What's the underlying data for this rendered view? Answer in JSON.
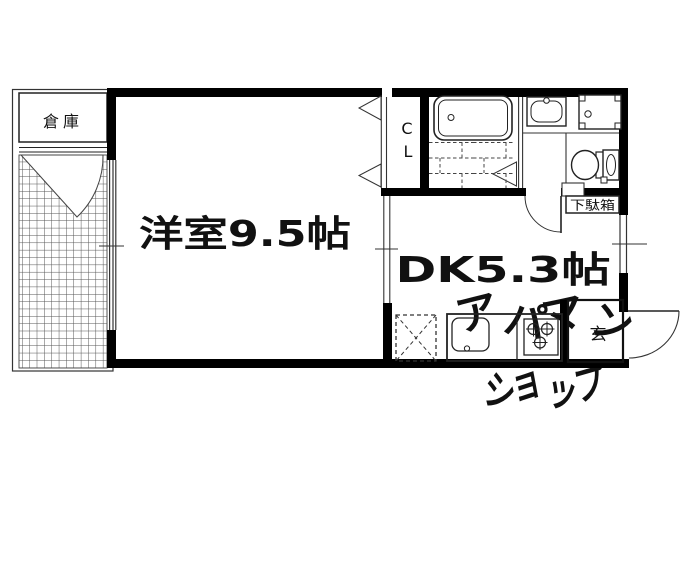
{
  "floorplan": {
    "rooms": {
      "storage": {
        "label": "倉庫"
      },
      "western_room": {
        "label": "洋室9.5帖"
      },
      "dining_kitchen": {
        "label": "DK5.3帖"
      },
      "closet": {
        "line1": "C",
        "line2": "L"
      },
      "shoe_cabinet": {
        "label": "下駄箱"
      },
      "entrance": {
        "label": "玄"
      }
    },
    "watermark": {
      "line1": "アパマン",
      "line2": "ショップ",
      "color": "#cccccc"
    },
    "colors": {
      "background": "#ffffff",
      "wall": "#000000",
      "line": "#333333",
      "grid": "#555555"
    }
  }
}
